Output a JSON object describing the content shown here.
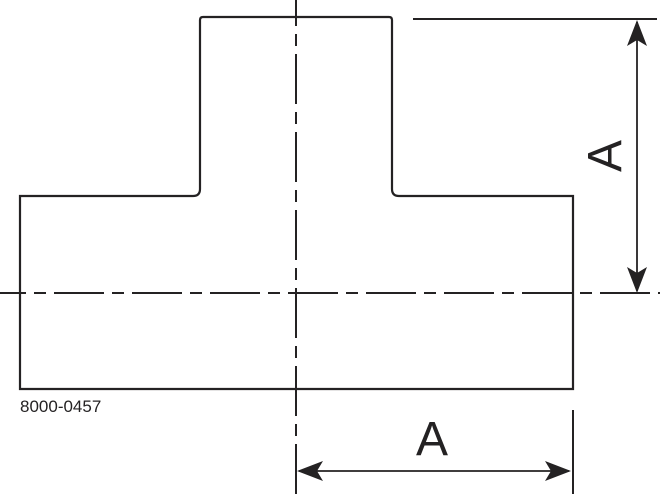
{
  "drawing": {
    "title": "tee-fitting-technical-drawing",
    "background_color": "#ffffff",
    "line_color": "#242223",
    "part_number": "8000-0457",
    "dimensions": {
      "vertical": {
        "label": "A"
      },
      "horizontal": {
        "label": "A"
      }
    }
  }
}
